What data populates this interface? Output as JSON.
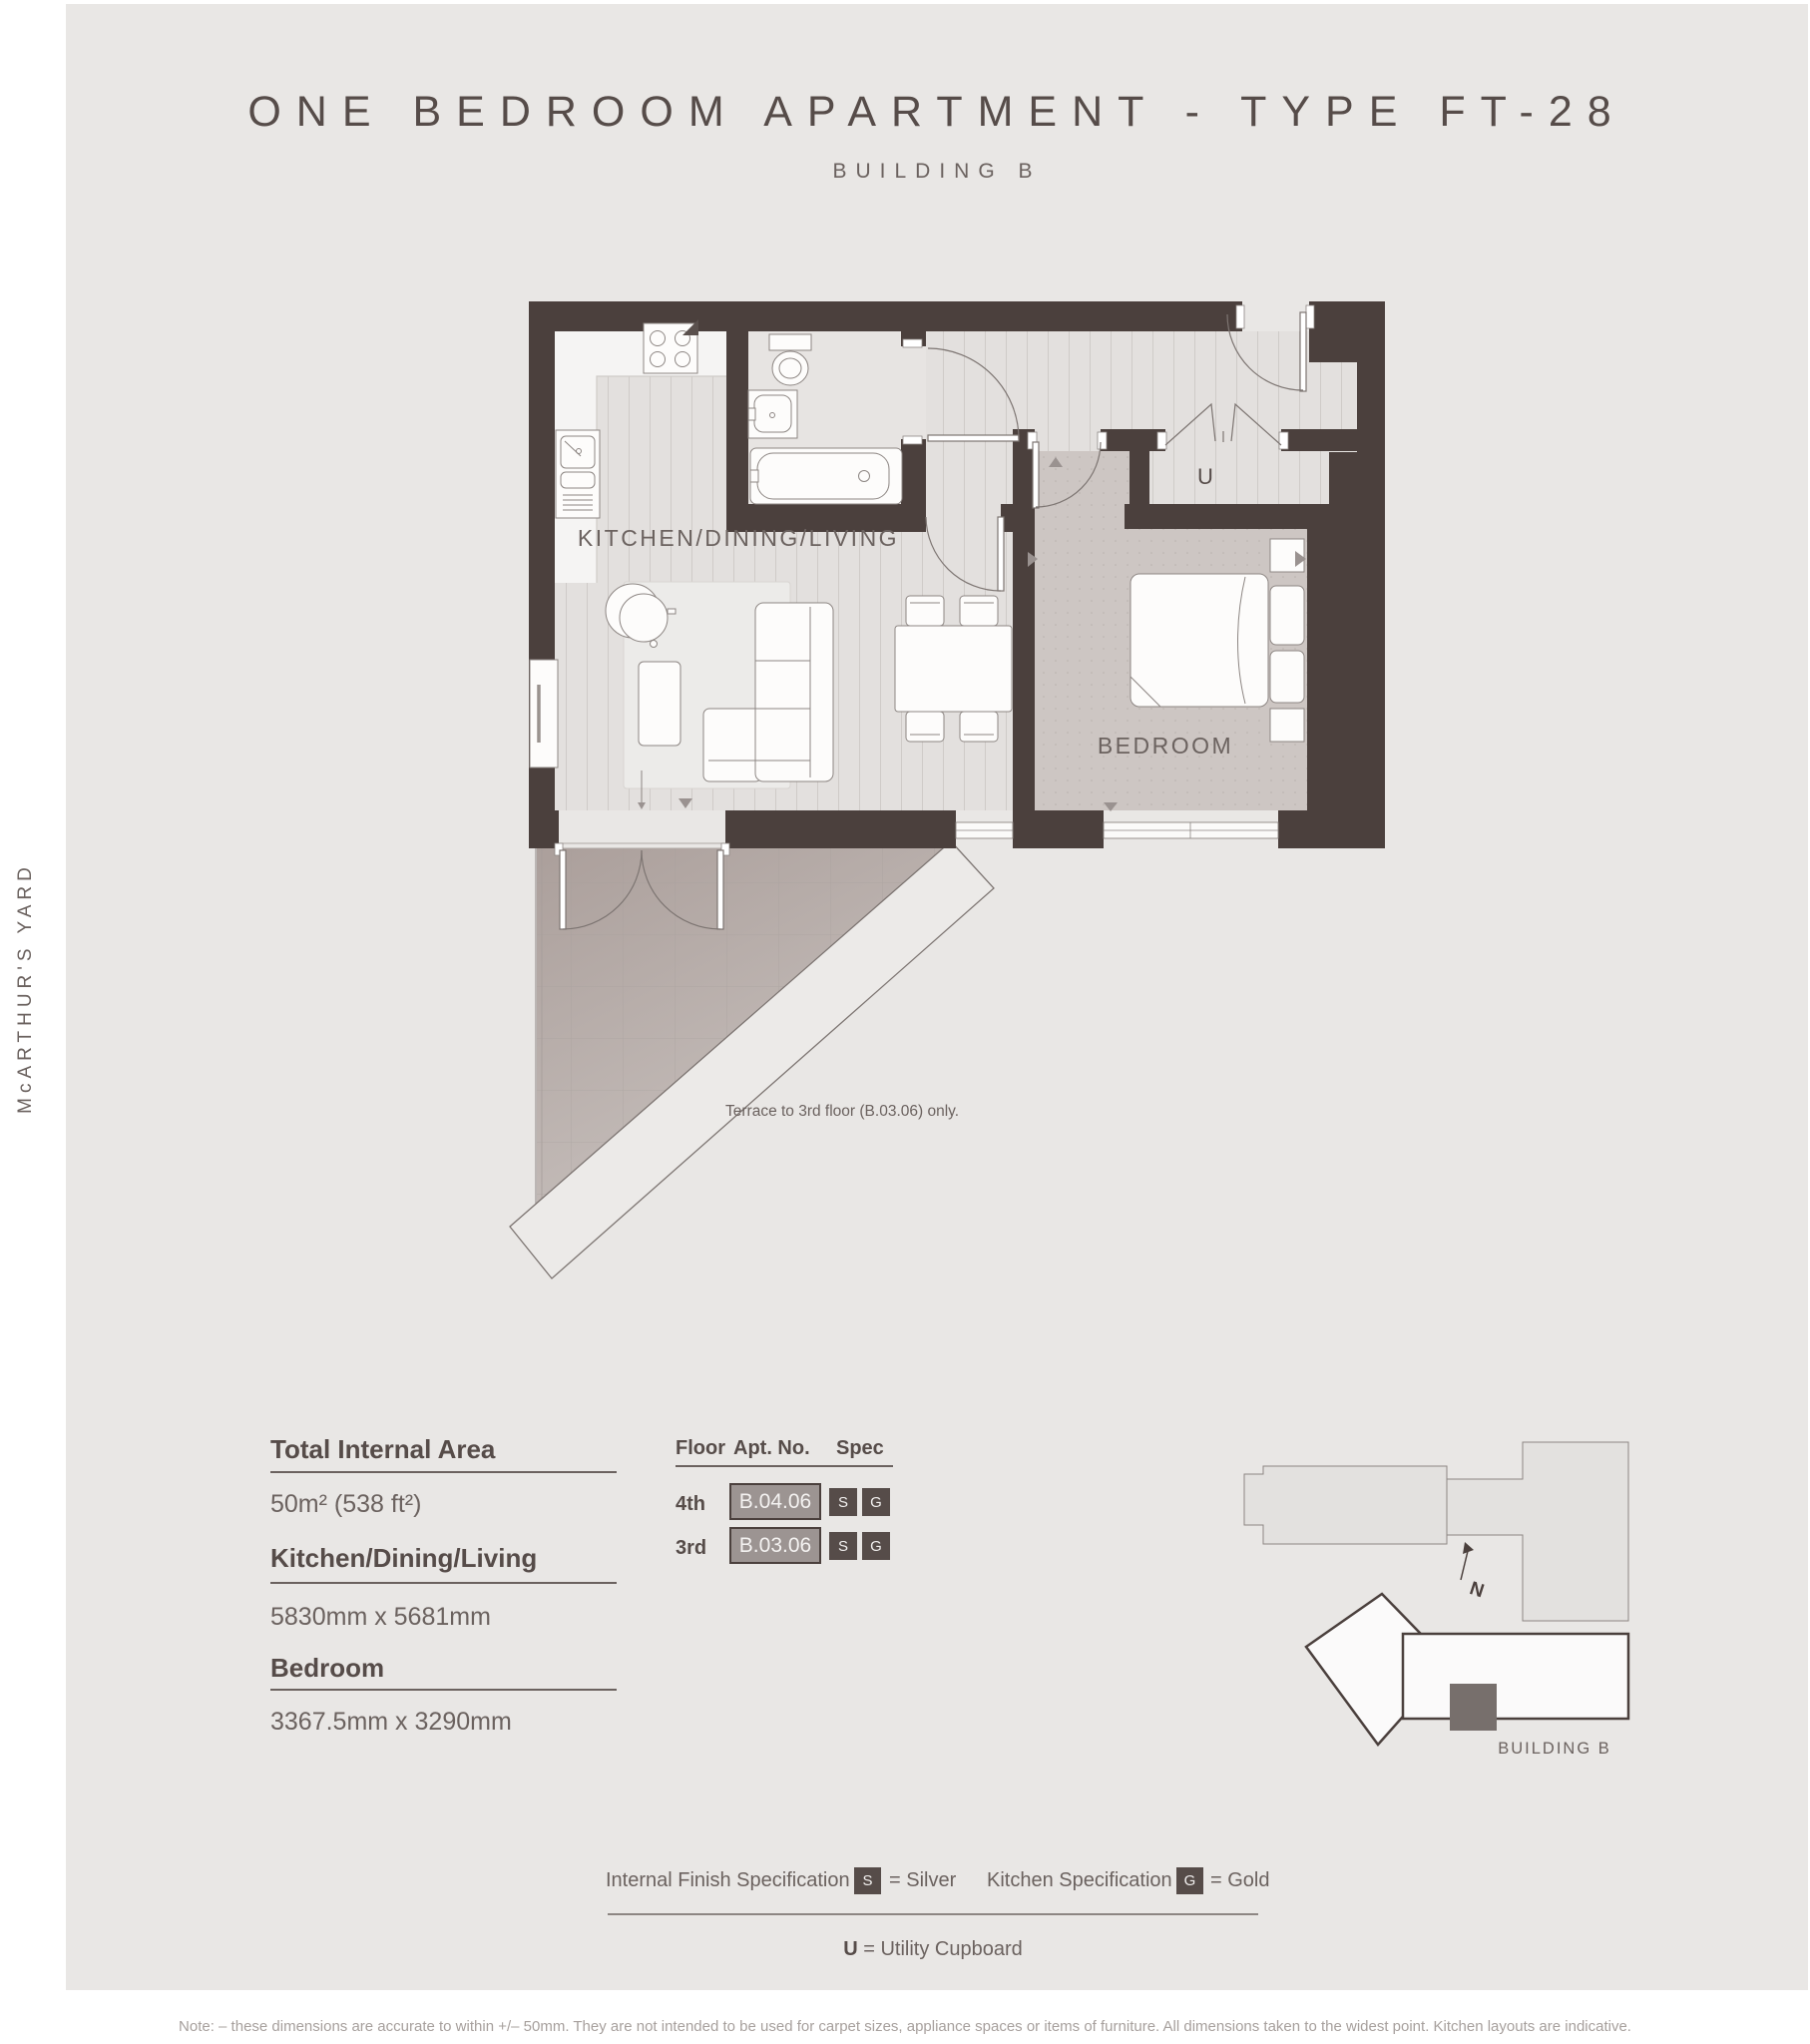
{
  "title": "ONE BEDROOM APARTMENT - TYPE FT-28",
  "subtitle": "BUILDING B",
  "side_label": "McARTHUR'S YARD",
  "plan": {
    "living_label": "KITCHEN/DINING/LIVING",
    "bedroom_label": "BEDROOM",
    "utility_label": "U",
    "terrace_note": "Terrace to 3rd floor (B.03.06) only."
  },
  "details": {
    "total_area_label": "Total Internal Area",
    "total_area_value": "50m² (538 ft²)",
    "kdl_label": "Kitchen/Dining/Living",
    "kdl_value": "5830mm x 5681mm",
    "bedroom_label": "Bedroom",
    "bedroom_value": "3367.5mm x 3290mm"
  },
  "table": {
    "headers": [
      "Floor",
      "Apt. No.",
      "Spec"
    ],
    "rows": [
      {
        "floor": "4th",
        "apt": "B.04.06",
        "spec_s": "S",
        "spec_g": "G"
      },
      {
        "floor": "3rd",
        "apt": "B.03.06",
        "spec_s": "S",
        "spec_g": "G"
      }
    ]
  },
  "sitemap": {
    "building_label": "BUILDING B",
    "north_label": "N"
  },
  "legend": {
    "finish_label": "Internal Finish Specification",
    "finish_badge": "S",
    "finish_value": "= Silver",
    "kitchen_label": "Kitchen Specification",
    "kitchen_badge": "G",
    "kitchen_value": "= Gold",
    "utility_key": "U",
    "utility_value": "= Utility Cupboard"
  },
  "footer_note": "Note: – these dimensions are accurate to within +/– 50mm. They are not intended to be used for carpet sizes, appliance spaces or items of furniture.  All dimensions taken to the widest point. Kitchen layouts are indicative.",
  "colors": {
    "wall": "#4b403d",
    "panel_bg": "#e9e7e5",
    "text_dark": "#564c49",
    "text_mid": "#6b625f",
    "apt_box_fill": "#9c9492",
    "spec_box_fill": "#564c49",
    "carpet": "#cdc6c3",
    "terrace": "#b1a8a4"
  }
}
